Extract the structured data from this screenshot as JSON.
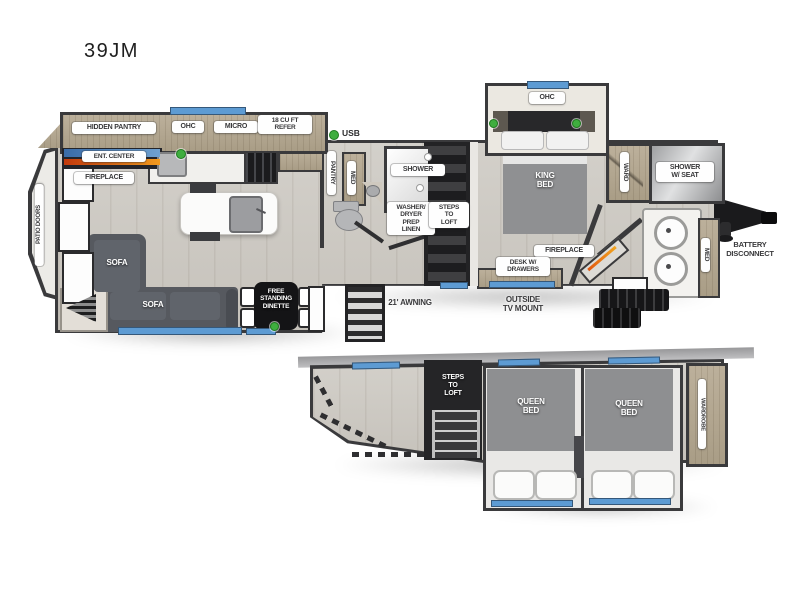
{
  "title": "39JM",
  "colors": {
    "wall": "#3a3a3c",
    "floor_wood": "#cdc9c2",
    "cabinet_tan": "#b2a691",
    "window_blue": "#5d9bd3",
    "usb_green": "#3fae3f",
    "sofa_gray": "#56595f",
    "mattress_gray": "#8f9092",
    "fireplace_orange": "#e2570f",
    "label_bg": "#ffffff",
    "label_text": "#38383a"
  },
  "main_floor": {
    "kitchen": {
      "hidden_pantry": "HIDDEN PANTRY",
      "ohc": "OHC",
      "micro": "MICRO",
      "refer": "18 CU FT\nREFER",
      "usb": "USB",
      "ent_center": "ENT. CENTER",
      "fireplace": "FIREPLACE"
    },
    "living": {
      "patio_doors": "PATIO DOORS",
      "sofa_chaise": "SOFA",
      "sofa_main": "SOFA",
      "dinette": "FREE\nSTANDING\nDINETTE"
    },
    "bath_mid": {
      "pantry": "PANTRY",
      "med": "MED",
      "shower": "SHOWER",
      "washer": "WASHER/\nDRYER\nPREP\nLINEN",
      "steps": "STEPS\nTO\nLOFT"
    },
    "bedroom": {
      "ohc": "OHC",
      "king_bed": "KING\nBED",
      "ward": "WARD",
      "fireplace": "FIREPLACE",
      "desk": "DESK W/\nDRAWERS"
    },
    "bath_front": {
      "shower_seat": "SHOWER\nW/ SEAT",
      "med": "MED"
    },
    "exterior": {
      "awning": "21' AWNING",
      "outside_tv": "OUTSIDE\nTV MOUNT",
      "battery": "BATTERY\nDISCONNECT"
    }
  },
  "loft": {
    "steps": "STEPS\nTO\nLOFT",
    "queen_bed_1": "QUEEN\nBED",
    "queen_bed_2": "QUEEN\nBED",
    "wardrobe": "WARDROBE"
  }
}
